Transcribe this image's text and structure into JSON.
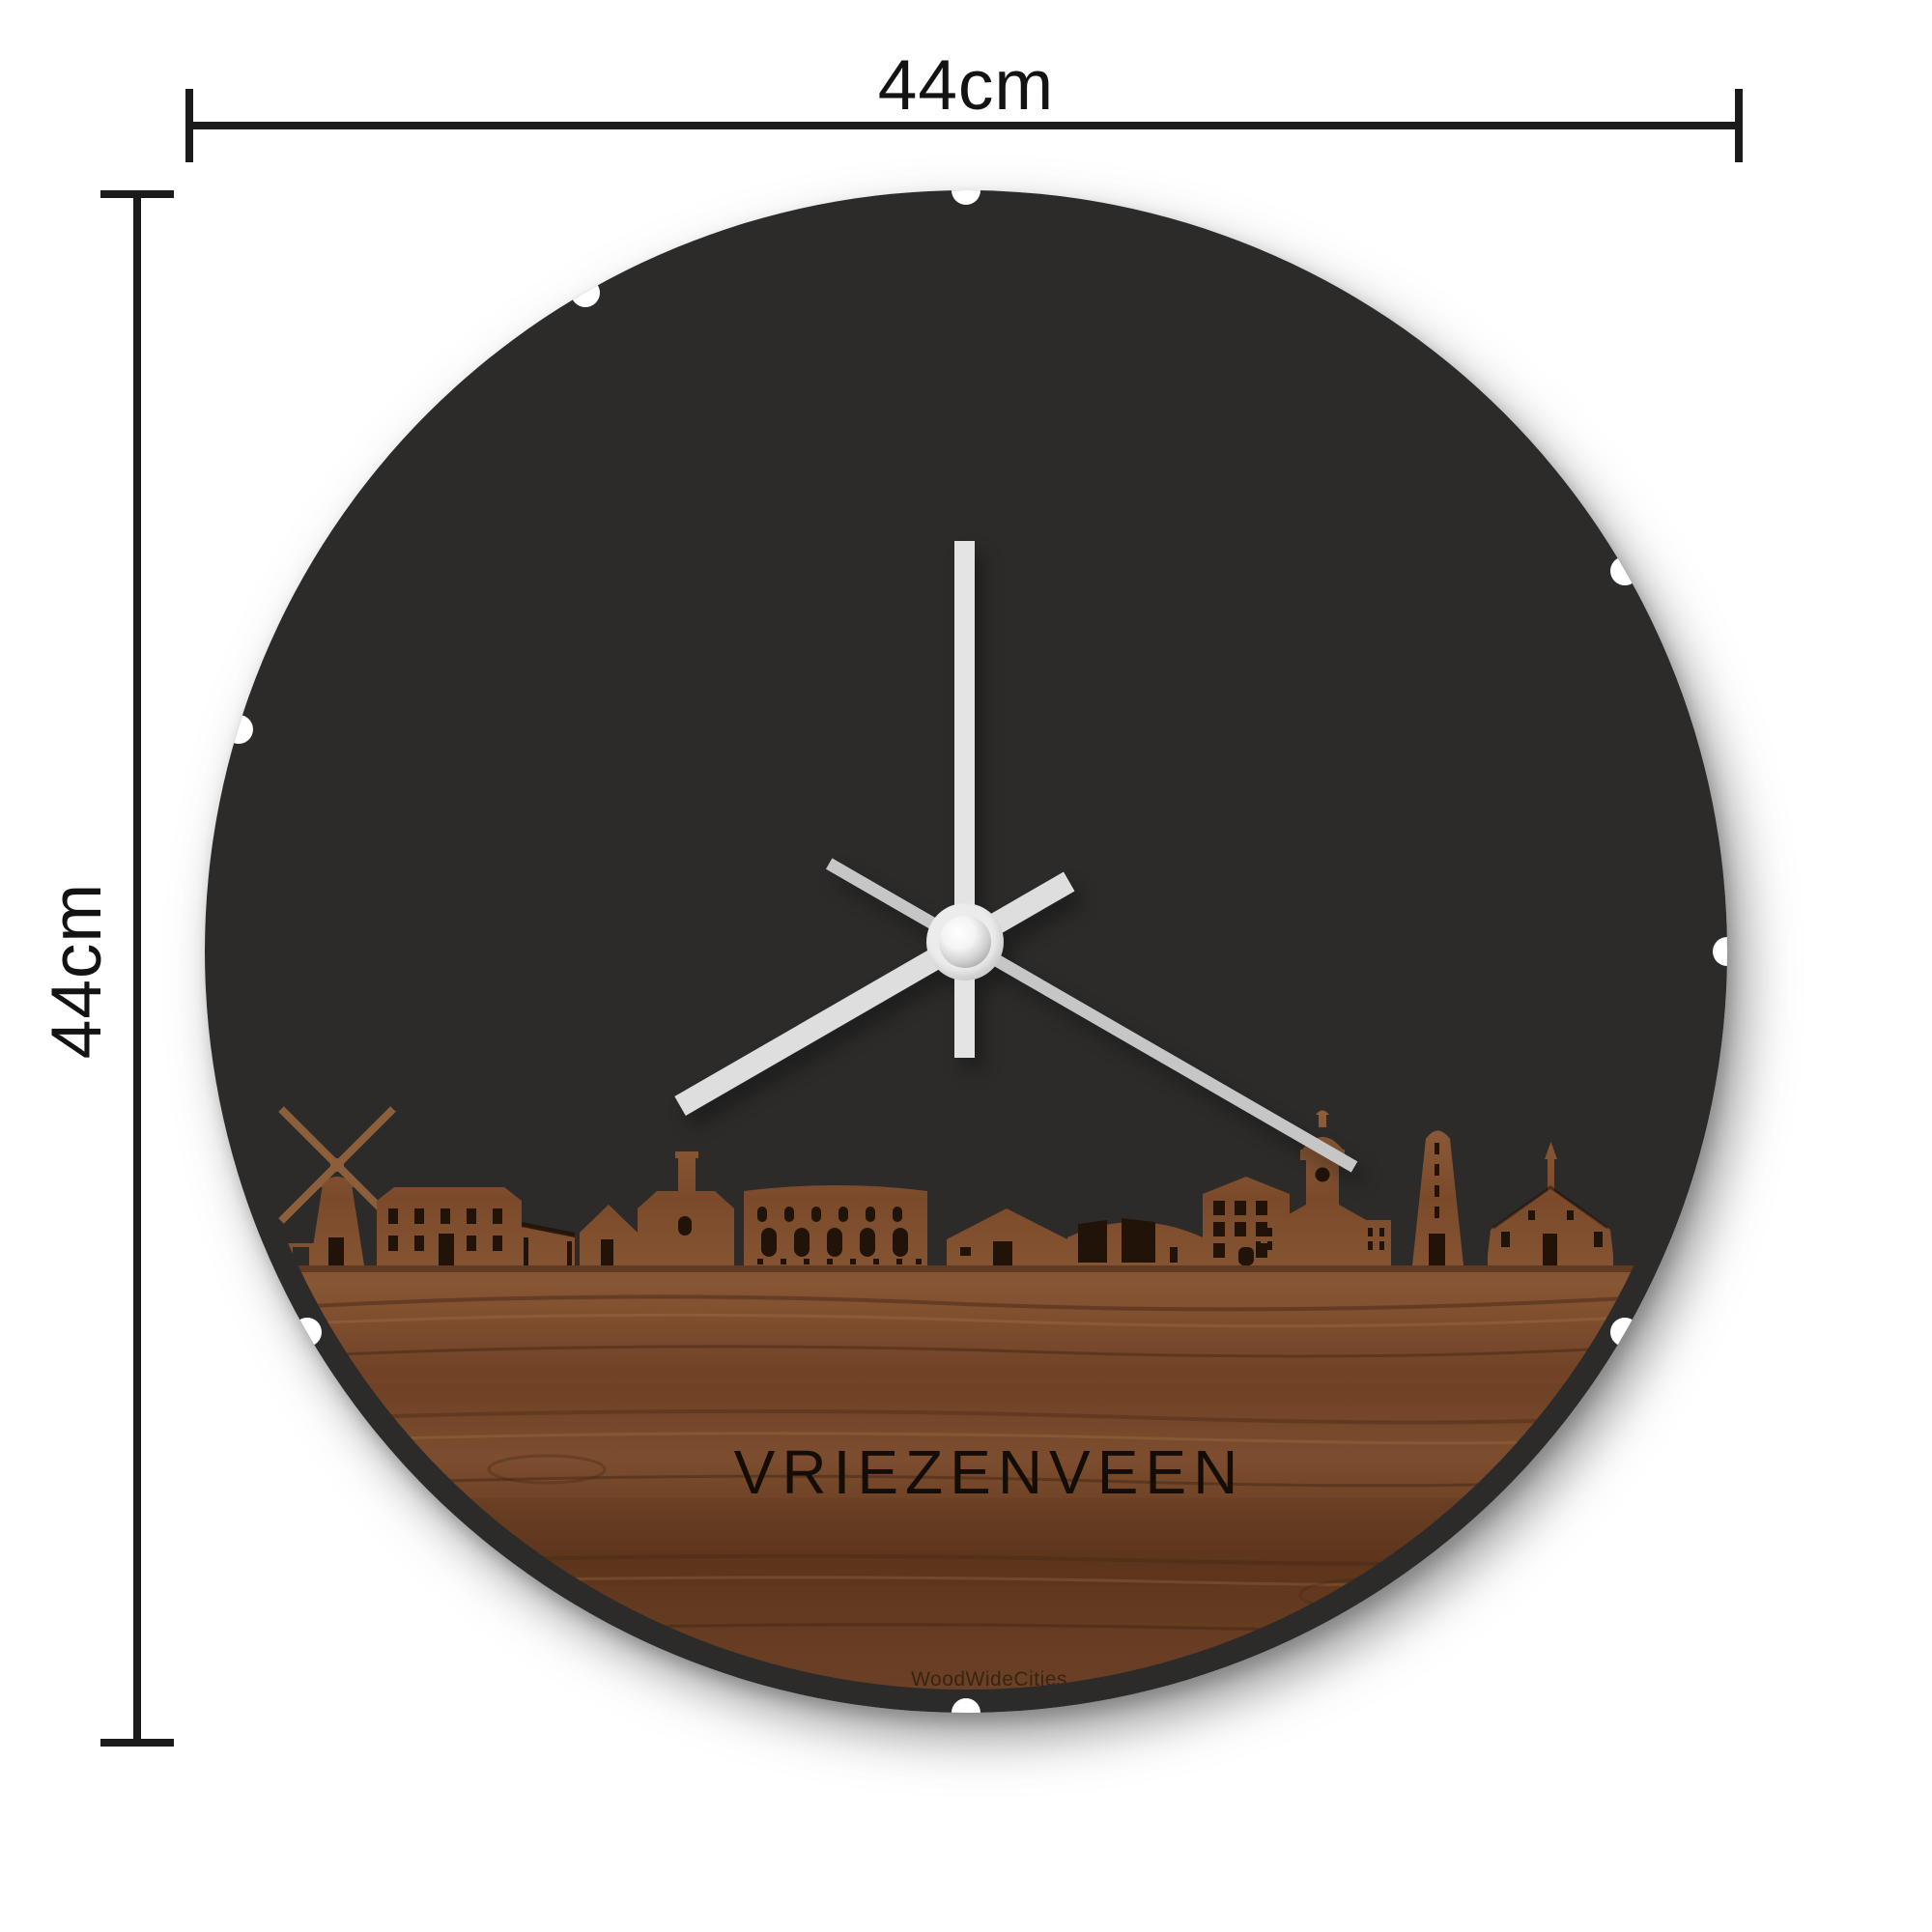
{
  "dimensions": {
    "width_label": "44cm",
    "height_label": "44cm"
  },
  "clock": {
    "city_name": "VRIEZENVEEN",
    "brand": "WoodWideCities",
    "face_color": "#2c2b2a",
    "wood_color": "#7a4a2b",
    "hand_color": "#e4e4e4",
    "second_hand_color": "#c6c6c6",
    "hands": {
      "minute_deg": 0,
      "hour_deg": 240,
      "second_deg": 120
    }
  }
}
